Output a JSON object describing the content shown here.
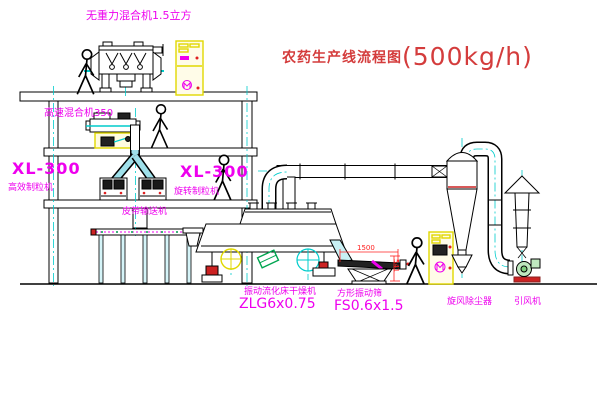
{
  "title": {
    "text": "农药生产线流程图",
    "capacity": "(500kg/h)"
  },
  "labels": {
    "gravity_mixer": "无重力混合机1.5立方",
    "high_speed_mixer": "高速混合机350",
    "granulator_left_model": "XL-300",
    "granulator_left_name": "高效制粒机",
    "granulator_mid_model": "XL-300",
    "granulator_mid_name": "旋转制粒机",
    "belt_conveyor": "皮带输送机",
    "dryer_name": "振动流化床干燥机",
    "dryer_model": "ZLG6x0.75",
    "screen_name": "方形振动筛",
    "screen_model": "FS0.6x1.5",
    "cyclone": "旋风除尘器",
    "fan": "引风机"
  },
  "dimensions": {
    "screen_length": "1500",
    "screen_height": "541"
  },
  "colors": {
    "label_magenta": "#ee00ee",
    "title_red": "#d43c3c",
    "dimension_red": "#ff2020",
    "cabinet_yellow": "#e0d800",
    "centerline_cyan": "#00cccc",
    "valve_green": "#00a550",
    "motor_red": "#cc2222"
  }
}
